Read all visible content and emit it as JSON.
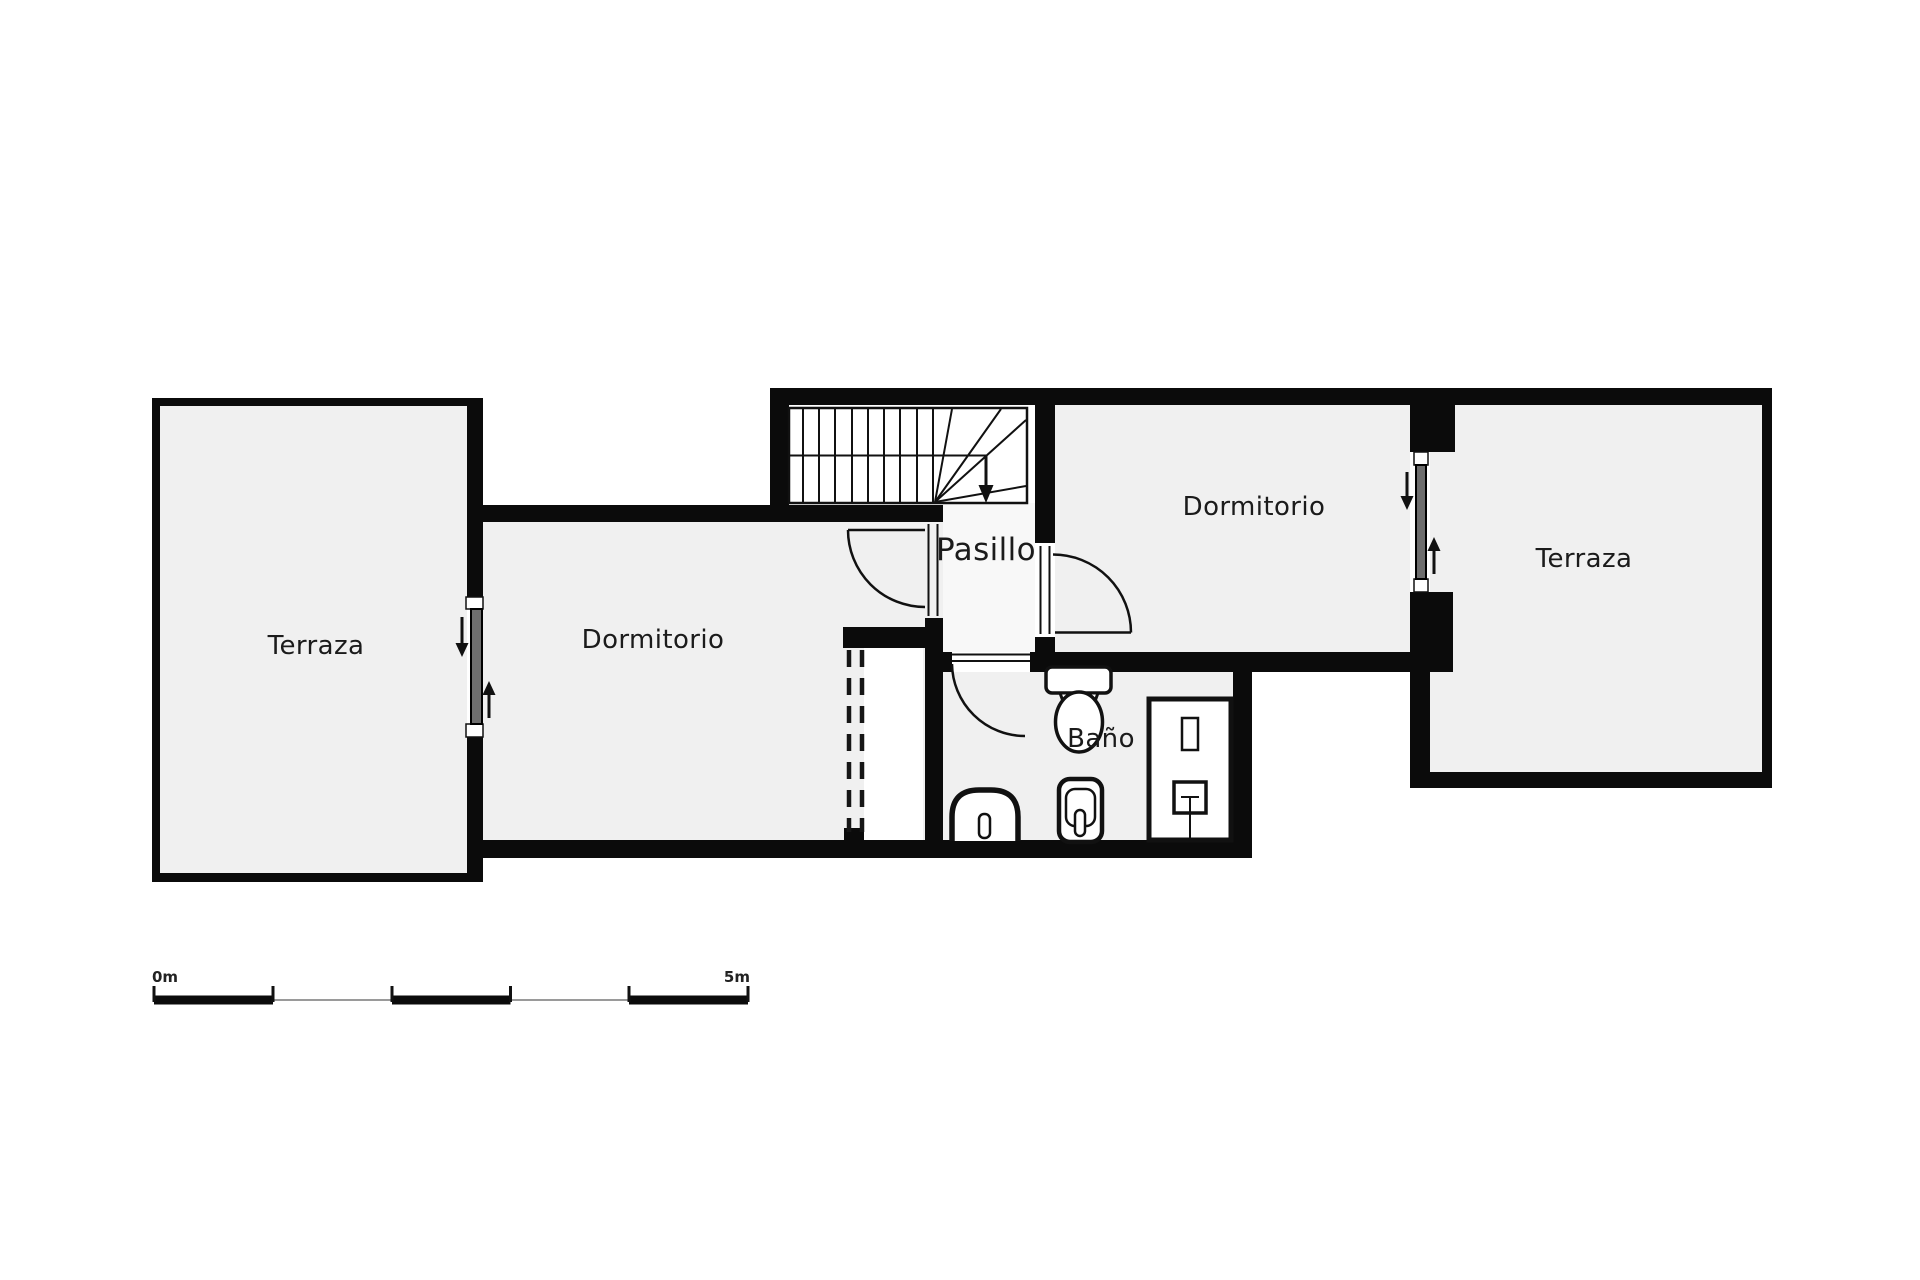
{
  "title": "Floor plan - upper floor",
  "rooms": {
    "terraza_left": {
      "label": "Terraza"
    },
    "dormitorio_left": {
      "label": "Dormitorio"
    },
    "pasillo": {
      "label": "Pasillo"
    },
    "bano": {
      "label": "Baño"
    },
    "dormitorio_right": {
      "label": "Dormitorio"
    },
    "terraza_right": {
      "label": "Terraza"
    }
  },
  "scale_bar": {
    "start_label": "0m",
    "end_label": "5m"
  },
  "colors": {
    "wall": "#0b0b0b",
    "room_fill": "#f0f0f0",
    "corridor_fill": "#f8f8f8",
    "stair_fill": "#ffffff",
    "closet_fill": "#ffffff",
    "background": "#ffffff",
    "text": "#1b1b1b",
    "glass": "#6e6e6e",
    "scale_thin": "#9a9a9a"
  }
}
